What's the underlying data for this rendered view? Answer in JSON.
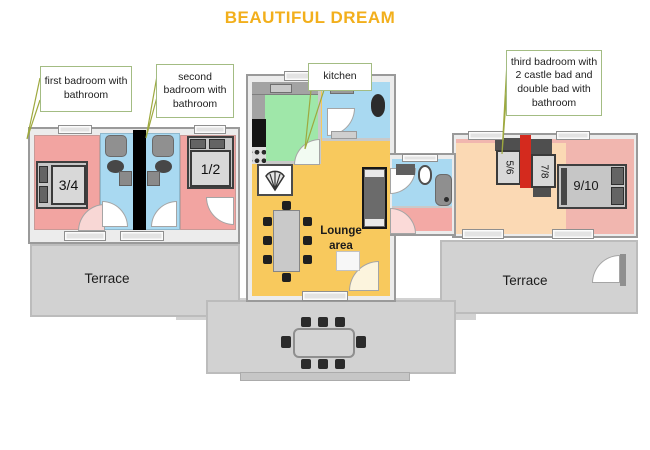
{
  "title": "BEAUTIFUL DREAM",
  "callouts": {
    "first_bedroom": "first badroom with bathroom",
    "second_bedroom": "second badroom with bathroom",
    "kitchen": "kitchen",
    "third_bedroom": "third badroom with 2 castle bad and double bad with bathroom"
  },
  "labels": {
    "lounge": "Lounge area",
    "terrace_left": "Terrace",
    "terrace_right": "Terrace"
  },
  "beds": {
    "bed_3_4": "3/4",
    "bed_1_2": "1/2",
    "bed_5_6": "5/6",
    "bed_7_8": "7/8",
    "bed_9_10": "9/10"
  },
  "colors": {
    "title_text": "#F2AF1C",
    "callout_border": "#A3BC83",
    "leader_line": "#9EA93F",
    "bedroom_pink": "#F2A4A1",
    "bedroom_salmon": "#F1B6AF",
    "bedroom_peach": "#FBD9B4",
    "bathroom_blue": "#A9D9F1",
    "kitchen_green": "#9FE7A9",
    "lounge_yellow": "#F8C95D",
    "terrace_gray": "#D2D2D2",
    "divider_black": "#000000",
    "divider_red": "#D42A1E"
  }
}
